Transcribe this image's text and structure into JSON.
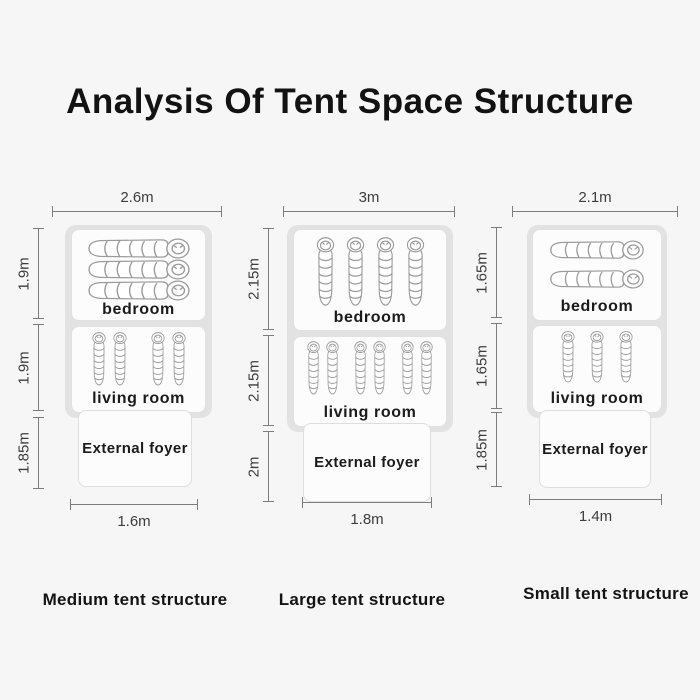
{
  "title": "Analysis Of Tent Space Structure",
  "colors": {
    "background": "#f6f6f6",
    "tent_outline": "#e2e2e2",
    "room_fill": "#fcfcfc",
    "room_border": "#e1e1e1",
    "dimension_line": "#7d7d7d",
    "text": "#1a1a1a"
  },
  "tents": [
    {
      "name": "medium",
      "caption": "Medium tent structure",
      "top_width": "2.6m",
      "bottom_width": "1.6m",
      "left_dims": [
        "1.9m",
        "1.9m",
        "1.85m"
      ],
      "rooms": [
        {
          "label": "bedroom",
          "bags": 3,
          "orientation": "horizontal"
        },
        {
          "label": "living room",
          "bags": 4,
          "orientation": "vertical",
          "grouping": "pairs"
        }
      ],
      "foyer_label": "External foyer"
    },
    {
      "name": "large",
      "caption": "Large tent structure",
      "top_width": "3m",
      "bottom_width": "1.8m",
      "left_dims": [
        "2.15m",
        "2.15m",
        "2m"
      ],
      "rooms": [
        {
          "label": "bedroom",
          "bags": 4,
          "orientation": "vertical"
        },
        {
          "label": "living room",
          "bags": 6,
          "orientation": "vertical",
          "grouping": "pairs"
        }
      ],
      "foyer_label": "External foyer"
    },
    {
      "name": "small",
      "caption": "Small tent structure",
      "top_width": "2.1m",
      "bottom_width": "1.4m",
      "left_dims": [
        "1.65m",
        "1.65m",
        "1.85m"
      ],
      "rooms": [
        {
          "label": "bedroom",
          "bags": 2,
          "orientation": "horizontal"
        },
        {
          "label": "living room",
          "bags": 3,
          "orientation": "vertical"
        }
      ],
      "foyer_label": "External foyer"
    }
  ]
}
